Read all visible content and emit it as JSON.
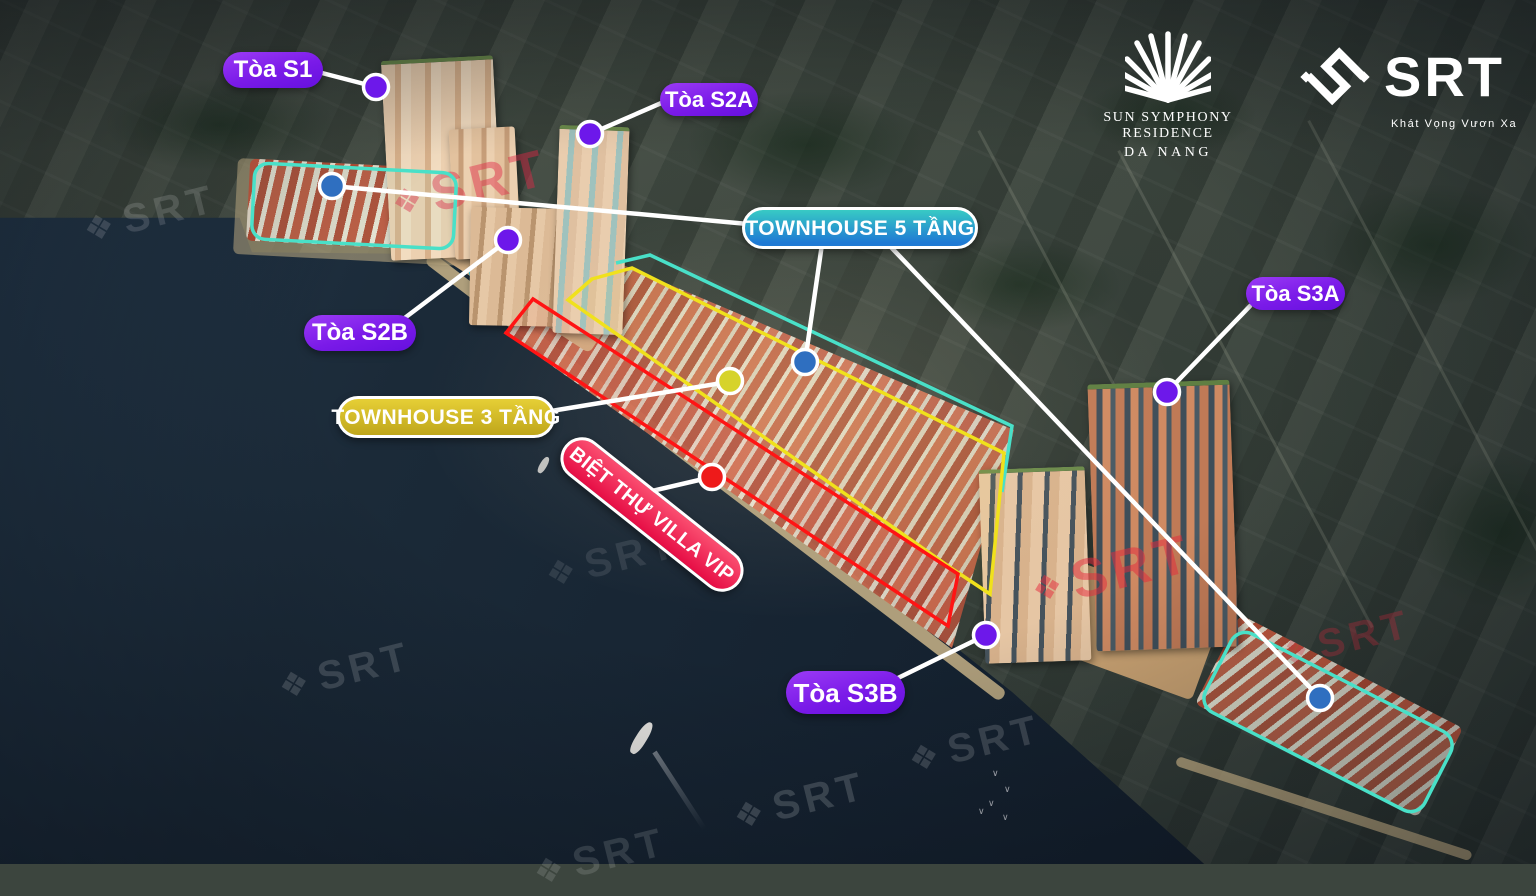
{
  "branding": {
    "sun_logo": {
      "line1": "SUN SYMPHONY RESIDENCE",
      "line2": "DA NANG"
    },
    "srt_logo": {
      "name": "SRT",
      "tagline": "Khát Vọng Vươn Xa"
    }
  },
  "labels": {
    "s1": "Tòa S1",
    "s2a": "Tòa S2A",
    "s2b": "Tòa S2B",
    "s3a": "Tòa S3A",
    "s3b": "Tòa S3B",
    "townhouse5": "TOWNHOUSE 5 TẦNG",
    "townhouse3": "TOWNHOUSE 3 TẦNG",
    "villa_vip": "BIỆT THỰ VILLA VIP"
  },
  "watermark": {
    "text": "SRT",
    "icon_glyph": "❖"
  },
  "colors": {
    "tower_marker_purple": "#6d18ea",
    "townhouse5_marker_blue": "#2f6fc0",
    "townhouse3_marker_yellow": "#d6d32b",
    "villa_marker_red": "#ee1a1a",
    "outline_teal": "#49e0c8",
    "outline_yellow": "#f0e11c",
    "outline_red": "#ff1414",
    "pill_purple": "#7a1ae8",
    "pill_blue_gradient_top": "#38cac4",
    "pill_blue_gradient_bottom": "#1f7ad4",
    "pill_gold": "#d9c12d",
    "pill_pink": "#ef1950"
  }
}
